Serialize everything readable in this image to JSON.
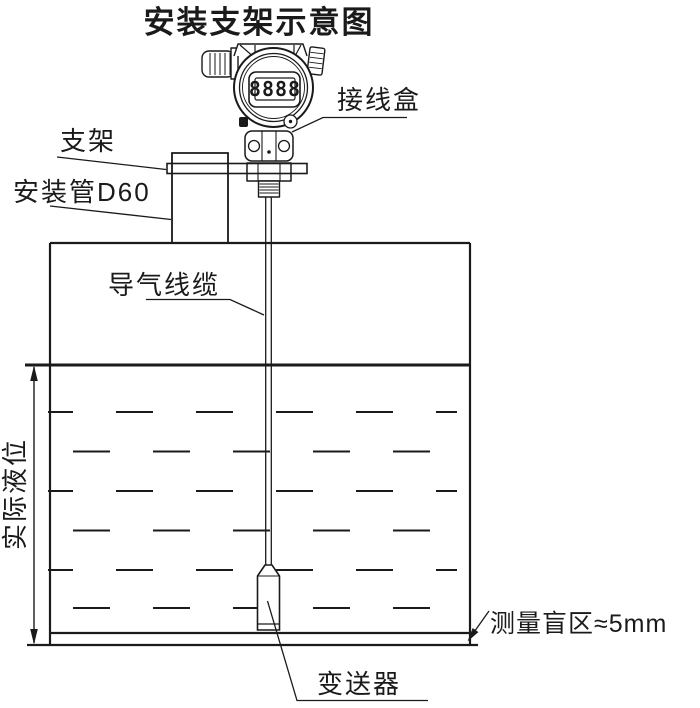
{
  "title": "安装支架示意图",
  "device": {
    "display_value": "8888"
  },
  "labels": {
    "junction_box": "接线盒",
    "bracket": "支架",
    "mounting_pipe": "安装管D60",
    "air_cable": "导气线缆",
    "actual_level": "实际液位",
    "blind_zone": "测量盲区≈5mm",
    "transmitter": "变送器"
  },
  "colors": {
    "line": "#1a1a1a",
    "background": "#ffffff"
  }
}
